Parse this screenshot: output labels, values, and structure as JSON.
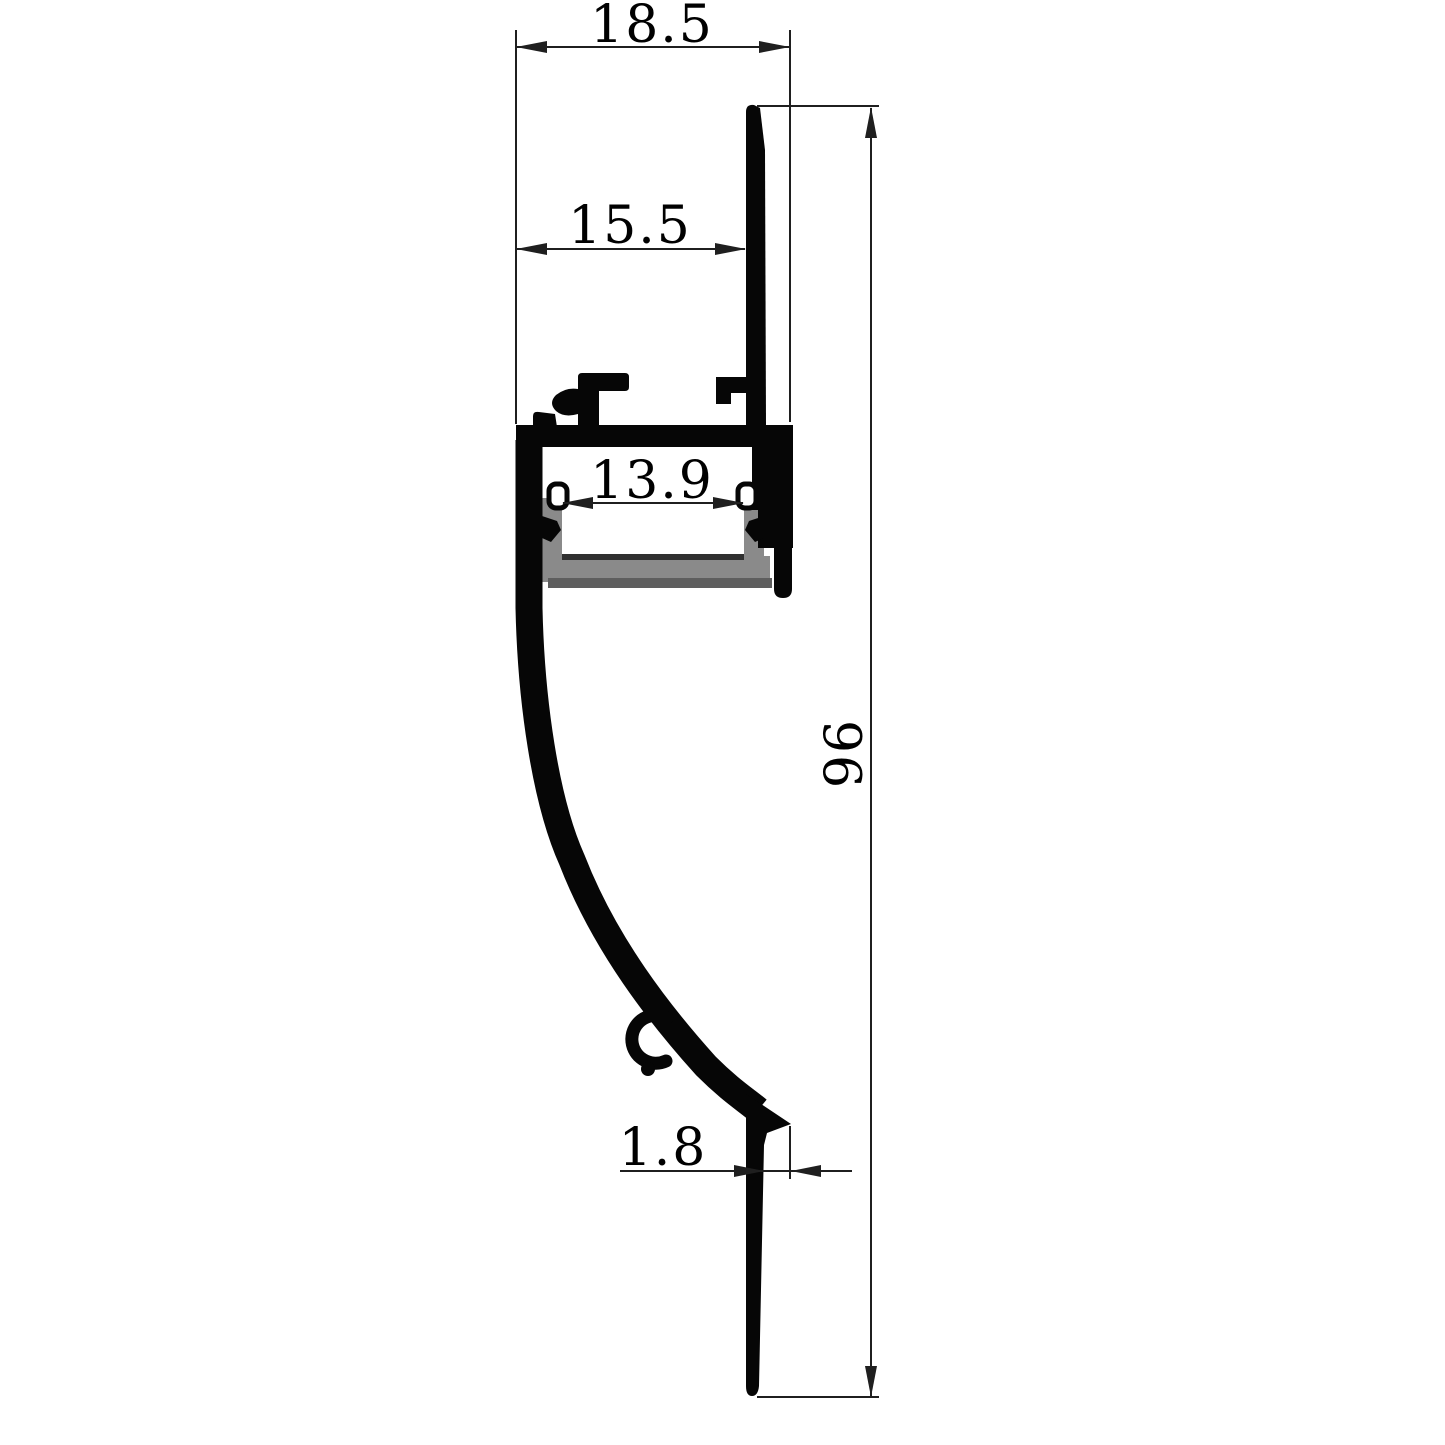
{
  "drawing": {
    "title": "Aluminium LED strip profile cross-section",
    "colors": {
      "background": "#ffffff",
      "outline": "#060606",
      "dimension": "#1f1f1f",
      "text": "#000000",
      "diffuser_gray": "#8a8a8a",
      "diffuser_shadow": "#5e5e5e",
      "channel_floor": "#303030"
    },
    "dimensions": {
      "top_width": "18.5",
      "mount_flange_width": "15.5",
      "channel_inner_width": "13.9",
      "overall_height": "96",
      "edge_thickness": "1.8"
    }
  }
}
